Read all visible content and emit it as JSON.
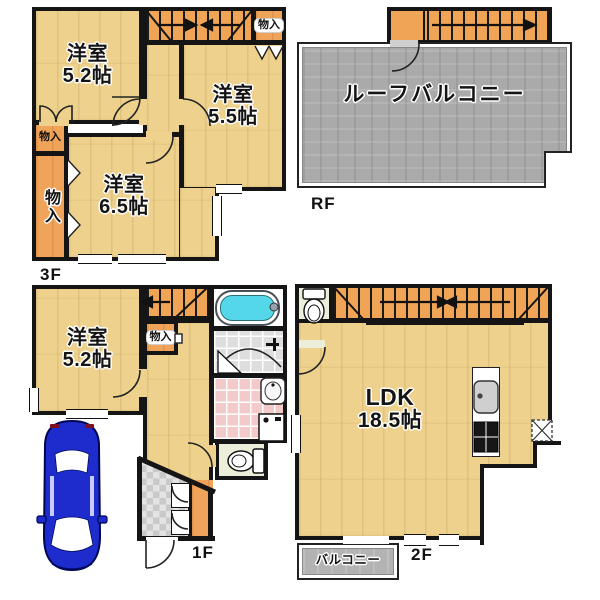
{
  "floors": {
    "f3": {
      "label": "3F",
      "room_52": {
        "name": "洋室",
        "size": "5.2帖"
      },
      "room_55": {
        "name": "洋室",
        "size": "5.5帖"
      },
      "room_65": {
        "name": "洋室",
        "size": "6.5帖"
      },
      "storage_top_right": "物入",
      "storage_left_small": "物入",
      "storage_left_tall": "物入"
    },
    "rf": {
      "label": "RF",
      "roof_balcony": "ルーフバルコニー"
    },
    "f1": {
      "label": "1F",
      "room_52": {
        "name": "洋室",
        "size": "5.2帖"
      },
      "storage": "物入"
    },
    "f2": {
      "label": "2F",
      "ldk": {
        "name": "LDK",
        "size": "18.5帖"
      },
      "balcony": "バルコニー"
    }
  },
  "colors": {
    "wall": "#151515",
    "floor_wood": "#edd18c",
    "corridor_orange": "#efa459",
    "stairs_orange": "#f0a455",
    "roof_balcony_gray": "#aaaaaa",
    "balcony_gray": "#b3b3b3",
    "bath_tile_gray": "#dedede",
    "washroom_pink": "#f2caca",
    "toilet_cream": "#edeeda",
    "entrance_tile": "#d8d8d8",
    "bathtub_cyan": "#54d7e8",
    "car_blue": "#1f2ccd"
  }
}
